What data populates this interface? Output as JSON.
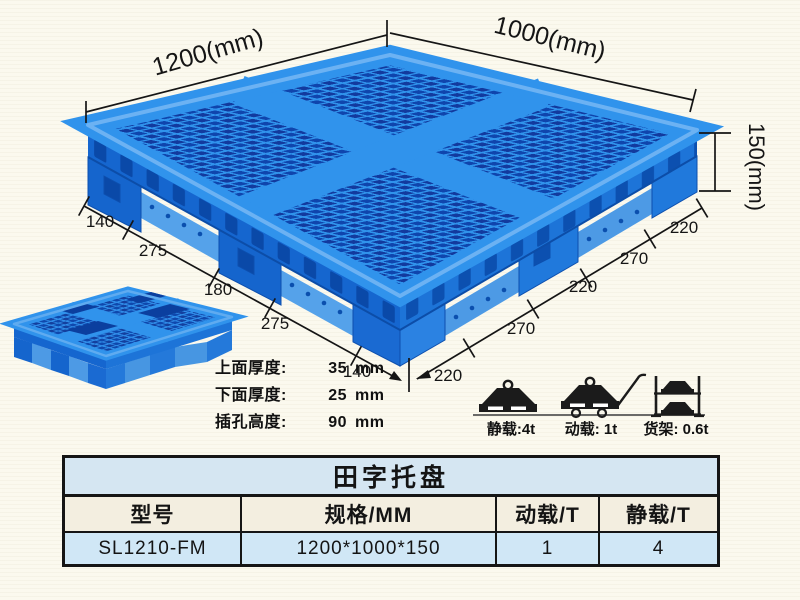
{
  "illustrations": {
    "main_pallet_alt": "blue plastic grid pallet, isometric view",
    "small_pallet_alt": "blue plastic pallet, small top view"
  },
  "dimensions": {
    "width_label": "1200(mm)",
    "depth_label": "1000(mm)",
    "height_label": "150(mm)",
    "left_edge": [
      "140",
      "275",
      "180",
      "275",
      "140"
    ],
    "right_edge": [
      "220",
      "270",
      "220",
      "270",
      "220"
    ]
  },
  "thickness_notes": [
    {
      "label": "上面厚度:",
      "value": "35",
      "unit": "mm"
    },
    {
      "label": "下面厚度:",
      "value": "25",
      "unit": "mm"
    },
    {
      "label": "插孔高度:",
      "value": "90",
      "unit": "mm"
    }
  ],
  "load_ratings": [
    {
      "name": "static-load",
      "label": "静载:4t"
    },
    {
      "name": "dynamic-load",
      "label": "动载: 1t"
    },
    {
      "name": "rack-load",
      "label": "货架: 0.6t"
    }
  ],
  "table": {
    "title": "田字托盘",
    "headers": [
      "型号",
      "规格/MM",
      "动载/T",
      "静载/T"
    ],
    "rows": [
      [
        "SL1210-FM",
        "1200*1000*150",
        "1",
        "4"
      ]
    ]
  },
  "colors": {
    "pallet_top": "#3093ec",
    "pallet_hole_dark": "#123a9e",
    "pallet_side": "#1566cf",
    "pallet_side_right": "#1d74d8",
    "pallet_rail": "#55a2ea",
    "dimension_line": "#151515",
    "table_title_bg": "#d5e6f2",
    "table_header_bg": "#f3eee0",
    "table_row_bg": "#d0e7f6",
    "page_background": "#fbf9ee"
  }
}
